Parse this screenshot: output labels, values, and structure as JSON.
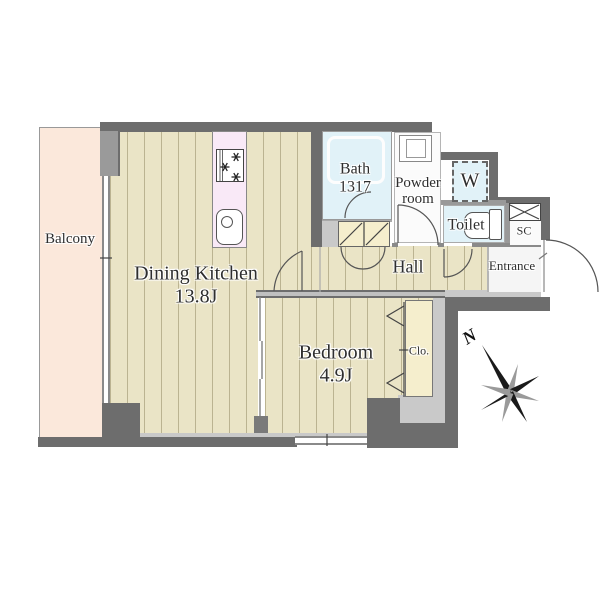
{
  "rooms": {
    "balcony": {
      "label": "Balcony"
    },
    "dining_kitchen": {
      "label": "Dining Kitchen",
      "size": "13.8J"
    },
    "bedroom": {
      "label": "Bedroom",
      "size": "4.9J"
    },
    "bath": {
      "label": "Bath",
      "size": "1317"
    },
    "powder_room": {
      "label_line1": "Powder",
      "label_line2": "room"
    },
    "washer_space": {
      "label": "W"
    },
    "toilet": {
      "label": "Toilet"
    },
    "shoe_closet": {
      "label": "SC"
    },
    "entrance": {
      "label": "Entrance"
    },
    "hall": {
      "label": "Hall"
    },
    "closet": {
      "label": "Clo."
    }
  },
  "compass": {
    "north_label": "N"
  },
  "colors": {
    "wall_dark": "#6d6d6d",
    "wall_light": "#c9c9c9",
    "floor_wood": "#eae4c6",
    "floor_stripe": "#b8b192",
    "balcony": "#fbe8db",
    "wet_area_blue": "#e1f2f8",
    "closet_cream": "#f5eecd",
    "kitchen_counter_pink": "#f9e9f7",
    "text": "#2e2e2e"
  }
}
